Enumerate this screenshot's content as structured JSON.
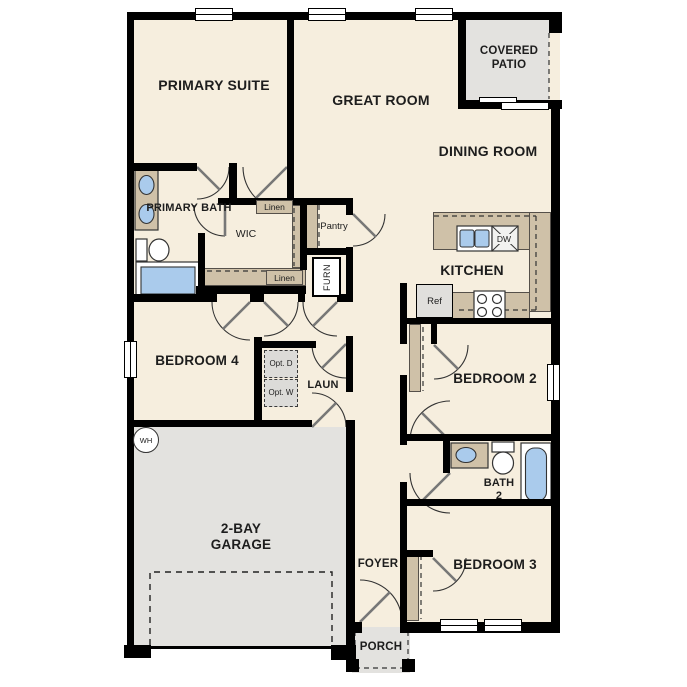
{
  "palette": {
    "wall": "#000000",
    "floor": "#f6eede",
    "outdoor": "#e3e2df",
    "counter": "#cfc1a8",
    "fixture_blue": "#aacbec",
    "appliance_gray": "#e0dfdc",
    "text": "#1d1d1d"
  },
  "rooms": {
    "primary_suite": "PRIMARY SUITE",
    "great_room": "GREAT ROOM",
    "covered_patio": "COVERED PATIO",
    "dining_room": "DINING ROOM",
    "primary_bath": "PRIMARY BATH",
    "wic": "WIC",
    "kitchen": "KITCHEN",
    "bedroom_4": "BEDROOM 4",
    "laundry": "LAUN",
    "bedroom_2": "BEDROOM 2",
    "garage": "2-BAY GARAGE",
    "bath_2": "BATH 2",
    "foyer": "FOYER",
    "bedroom_3": "BEDROOM 3",
    "porch": "PORCH"
  },
  "fixtures": {
    "linen_upper": "Linen",
    "linen_lower": "Linen",
    "pantry": "Pantry",
    "furnace": "FURN",
    "refrigerator": "Ref",
    "dishwasher": "DW",
    "water_heater": "WH",
    "optional_dryer": "Opt. D",
    "optional_washer": "Opt. W"
  }
}
